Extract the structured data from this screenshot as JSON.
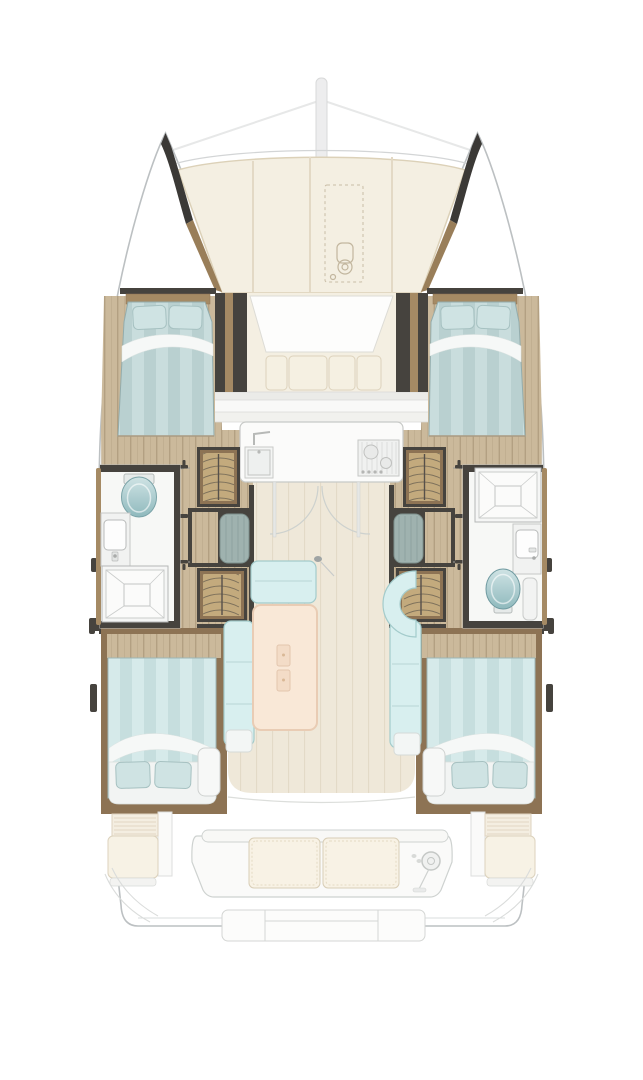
{
  "diagram": {
    "kind": "boat-floor-plan",
    "vessel_type": "sailing-catamaran",
    "view": "top-down interior and deck layout",
    "cabins": 4,
    "bathrooms": 2,
    "areas": {
      "foredeck": {
        "items": [
          "mast",
          "rigging-lines",
          "port-bow-locker",
          "starboard-bow-locker",
          "sunpad-cushions",
          "anchor-hatch",
          "windlass"
        ]
      },
      "forward-cockpit": {
        "items": [
          "lounge-pad",
          "bench-cushions",
          "windscreen-bands"
        ]
      },
      "port-forward-cabin": {
        "items": [
          "double-berth",
          "two-pillows",
          "duvet",
          "wood-floor",
          "headboard"
        ]
      },
      "starboard-forward-cabin": {
        "items": [
          "double-berth",
          "two-pillows",
          "duvet",
          "wood-floor",
          "headboard"
        ]
      },
      "port-bathroom": {
        "items": [
          "toilet",
          "washbasin",
          "shower-tray"
        ]
      },
      "starboard-bathroom": {
        "items": [
          "shower-tray",
          "washbasin",
          "toilet"
        ]
      },
      "port-hull-corridor": {
        "items": [
          "hanging-locker-forward",
          "hanging-locker-aft",
          "companionway-steps",
          "door-swing-arcs"
        ]
      },
      "starboard-hull-corridor": {
        "items": [
          "hanging-locker-forward",
          "hanging-locker-aft",
          "companionway-steps",
          "door-swing-arcs"
        ]
      },
      "galley": {
        "items": [
          "countertop",
          "sink",
          "faucet",
          "stove-with-burners",
          "sliding-door-swings"
        ]
      },
      "salon": {
        "items": [
          "dining-table",
          "table-inset-panels",
          "forward-bench",
          "port-bench",
          "starboard-bench",
          "curved-seat",
          "door-handle"
        ]
      },
      "port-aft-cabin": {
        "items": [
          "double-berth",
          "two-pillows",
          "duvet",
          "vanity-seat",
          "wood-floor"
        ]
      },
      "starboard-aft-cabin": {
        "items": [
          "double-berth",
          "two-pillows",
          "duvet",
          "vanity-seat",
          "wood-floor"
        ]
      },
      "aft-cockpit": {
        "items": [
          "bench-two-cushions",
          "helm-wheel",
          "helm-console",
          "port-side-seat",
          "starboard-side-seat",
          "engine-hatch-slats",
          "transom-steps",
          "davit-lines"
        ]
      }
    }
  },
  "colors": {
    "hull_line": "#bcc0c2",
    "hull_line_soft": "#dadddd",
    "wall_dark": "#46433e",
    "wood_frame": "#8d7354",
    "wood_trim": "#a58a64",
    "wood_base": "#cbb99b",
    "wood_grain": "#b3a082",
    "cream": "#f4efe2",
    "cream_border": "#dcd1b8",
    "counter": "#fbfbfa",
    "appliance_line": "#c7c9c7",
    "salon_floor": "#efe8d9",
    "salon_floor_line": "#e3dac7",
    "sofa": "#d8efef",
    "sofa_border": "#a3cbcb",
    "bed_stripe_a": "#b9d0d0",
    "bed_stripe_b": "#c9dddd",
    "bed_stripe_a2": "#c6dede",
    "bed_stripe_b2": "#d6eaea",
    "pillow": "#cfe3e3",
    "pillow_border": "#a6c1c1",
    "sheet": "#f6f8f7",
    "table": "#f9e8d7",
    "table_border": "#e9ccb4",
    "toilet_light": "#cfe3e4",
    "toilet_dark": "#8fb9bd",
    "locker_tan": "#c3aa7d",
    "locker_line": "#5e574b",
    "steps_teal": "#9fb2af",
    "fitting_gray": "#9fa4a4",
    "faded_line": "#ced2d0"
  }
}
